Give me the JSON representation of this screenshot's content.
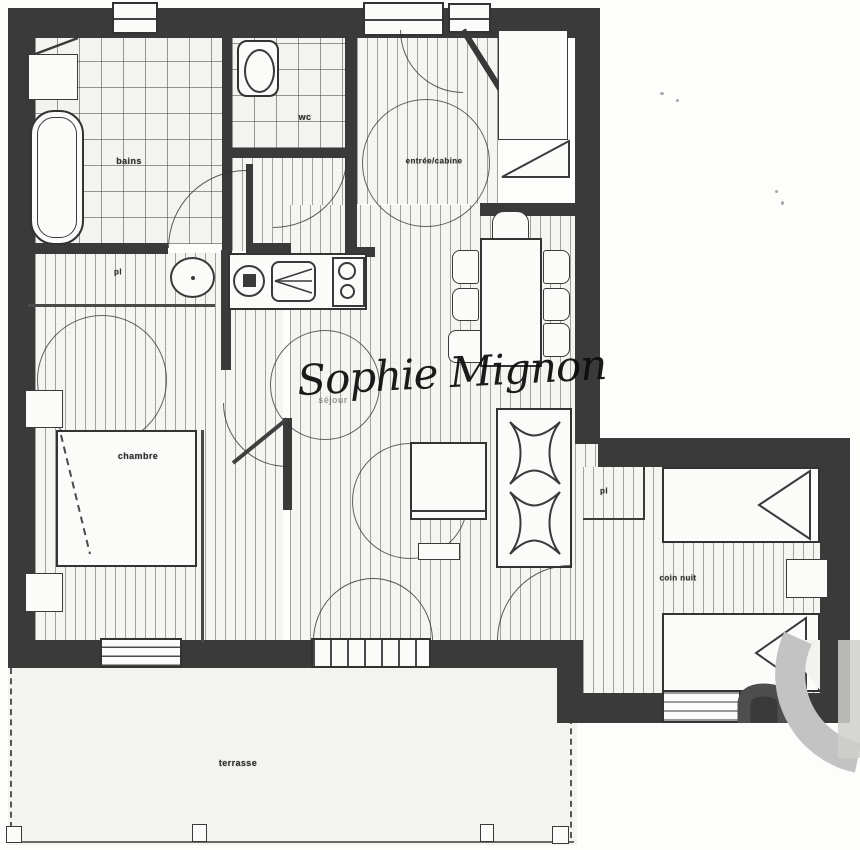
{
  "plan": {
    "title": "apartment floor plan scan",
    "watermark": "Sophie Mignon",
    "labels": {
      "bathroom": "bains",
      "wc": "wc",
      "entry": "entrée/cabine",
      "bedroom_closet": "pl",
      "bedroom": "chambre",
      "living_room": "séjour",
      "annex_closet": "pl",
      "sleeping_corner": "coin nuit",
      "terrace": "terrasse"
    },
    "colors": {
      "wall": "#3a3a3a",
      "paper": "#f4f4f0",
      "hatch_line": "#3c3c3c",
      "watermark_text": "#0b0b0b",
      "agency_logo_gray": "#c3c3c3"
    }
  }
}
